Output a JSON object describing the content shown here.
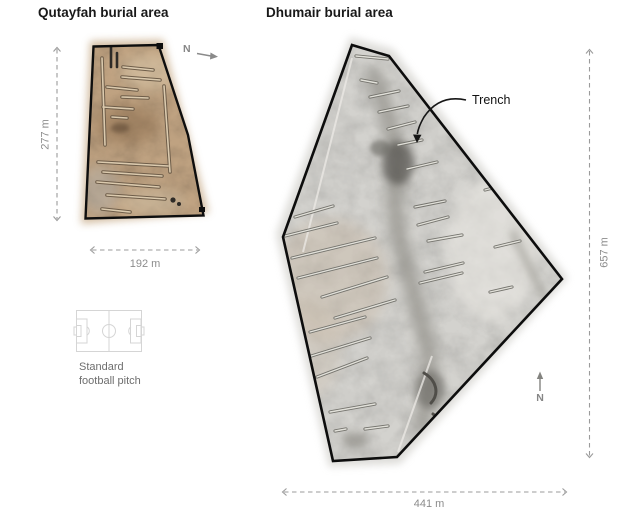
{
  "qutayfah": {
    "title": "Qutayfah burial area",
    "height_label": "277 m",
    "width_label": "192 m",
    "north_label": "N"
  },
  "dhumair": {
    "title": "Dhumair burial area",
    "height_label": "657 m",
    "width_label": "441 m",
    "north_label": "N",
    "trench_label": "Trench"
  },
  "legend": {
    "football_pitch_label": "Standard football pitch"
  },
  "icons": {
    "north_arrow": "north-arrow-icon",
    "football_pitch": "football-pitch-icon",
    "trench_pointer": "trench-pointer-icon"
  },
  "colors": {
    "boundary_outline": "#0e0e0e",
    "title_text": "#191919",
    "measurement": "#9b9b9b",
    "annotation_text": "#121212",
    "legend_text": "#6e6e6e",
    "qutayfah_terrain_base": "#bfa281",
    "dhumair_terrain_base": "#d3d2ce"
  }
}
